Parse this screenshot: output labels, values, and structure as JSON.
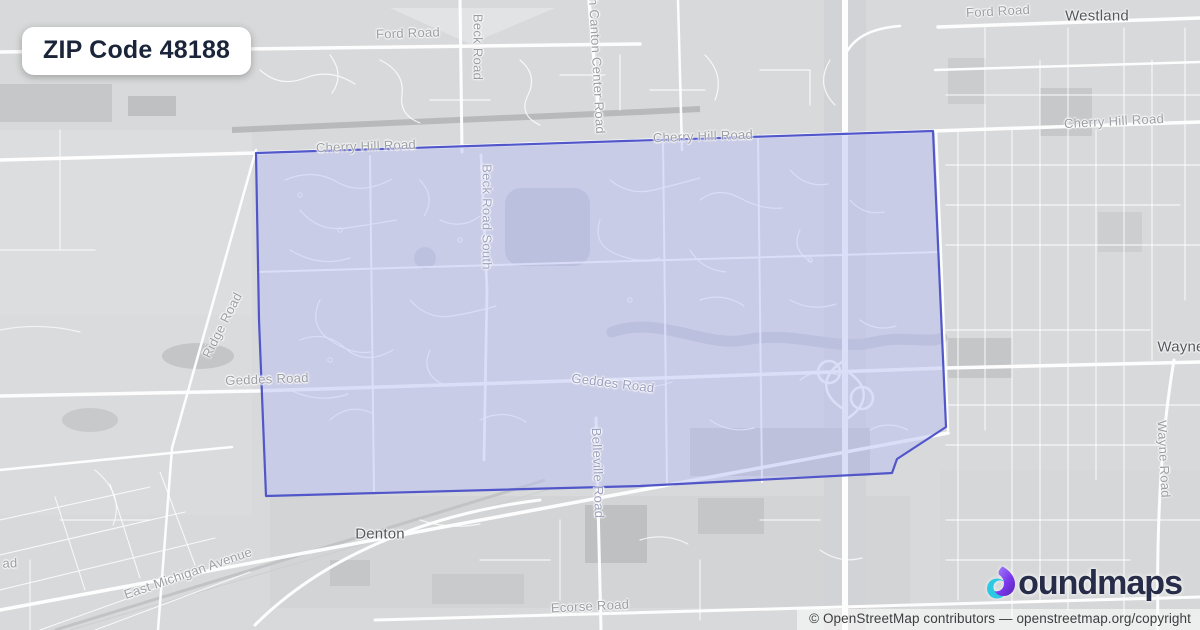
{
  "badge": {
    "title": "ZIP Code 48188"
  },
  "map": {
    "labels": {
      "ford_road_left": "Ford Road",
      "ford_road_right": "Ford Road",
      "westland": "Westland",
      "cherry_hill_left": "Cherry Hill Road",
      "cherry_hill_center": "Cherry Hill Road",
      "cherry_hill_right": "Cherry Hill Road",
      "beck_road": "Beck Road",
      "canton_center": "th Canton Center Road",
      "beck_road_south": "Beck Road South",
      "ridge_road": "Ridge Road",
      "geddes_left": "Geddes Road",
      "geddes_center": "Geddes Road",
      "wayne": "Wayne",
      "wayne_road": "Wayne Road",
      "belleville_road": "Belleville Road",
      "denton": "Denton",
      "east_michigan": "East Michigan Avenue",
      "ecorse_road": "Ecorse Road",
      "road_fragment": "ad"
    },
    "region": {
      "name": "ZIP 48188 boundary",
      "fill": "rgba(186,192,242,0.5)",
      "stroke": "#5156c9"
    },
    "colors": {
      "land": "#d8d9da",
      "roads": "#ffffff",
      "boundary_stroke": "#5156c9",
      "road_label": "#9b9ea3",
      "city_label": "#54585d"
    }
  },
  "footer": {
    "logo_text": "oundmaps",
    "logo_colors": {
      "navy": "#272c49",
      "purple": "#7c3aed",
      "teal": "#2cc9e2"
    },
    "attribution": "© OpenStreetMap contributors — openstreetmap.org/copyright"
  }
}
